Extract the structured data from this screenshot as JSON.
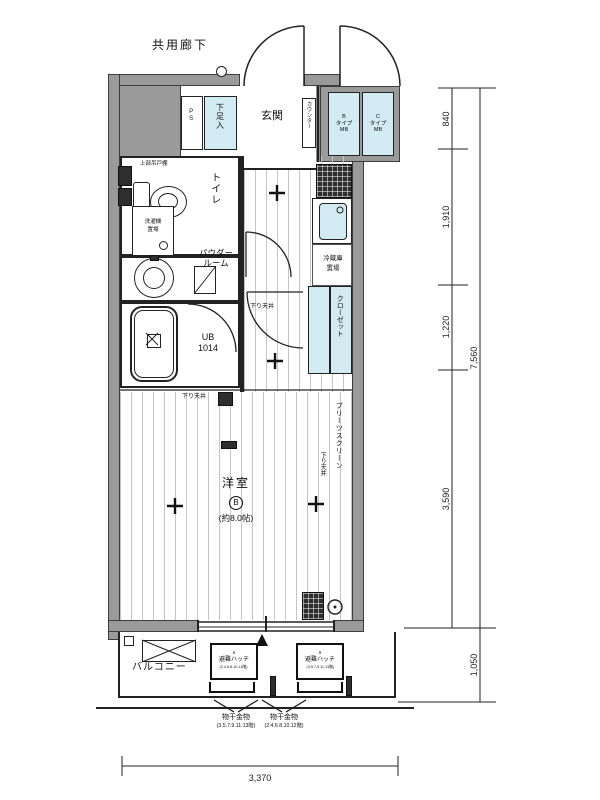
{
  "labels": {
    "common_corridor": "共用廊下",
    "entrance": "玄関",
    "shoe_box": "下足入",
    "ps": "PS",
    "counter": "カウンター",
    "mb_left": {
      "l1": "B",
      "l2": "タイプ",
      "l3": "MB"
    },
    "mb_right": {
      "l1": "C",
      "l2": "タイプ",
      "l3": "MB"
    },
    "toilet": "トイレ",
    "upper_shelf": "上部吊戸棚",
    "laundry_l1": "洗濯機",
    "laundry_l2": "置場",
    "powder_l1": "パウダー",
    "powder_l2": "ルーム",
    "bath_l1": "UB",
    "bath_l2": "1014",
    "fridge_l1": "冷蔵庫",
    "fridge_l2": "置場",
    "closet": "クローゼット",
    "screen": "プリーツスクリーン",
    "lowered_ceiling": "下り天井",
    "room": "洋室",
    "room_mark": "B",
    "room_size": "(約8.0帖)",
    "balcony": "バルコニー",
    "hatch": "避難ハッチ",
    "hatch_caret": "∧",
    "hatch_floors_left": "(2.4.6.8.10.12階)",
    "hatch_floors_right": "(3.5.7.9.11.13階)",
    "pole": "物干金物",
    "pole_floors_left": "(3.5.7.9.11.13階)",
    "pole_floors_right": "(2.4.6.8.10.12階)"
  },
  "dimensions": {
    "top_right": "840",
    "upper_right": "1,910",
    "mid_right": "1,220",
    "lower_right": "3,590",
    "balcony_right": "1,050",
    "total_right": "7,560",
    "bottom_width": "3,370"
  },
  "colors": {
    "wall": "#9a9a9a",
    "fixture_blue": "#d2eaf2",
    "line": "#222222"
  }
}
